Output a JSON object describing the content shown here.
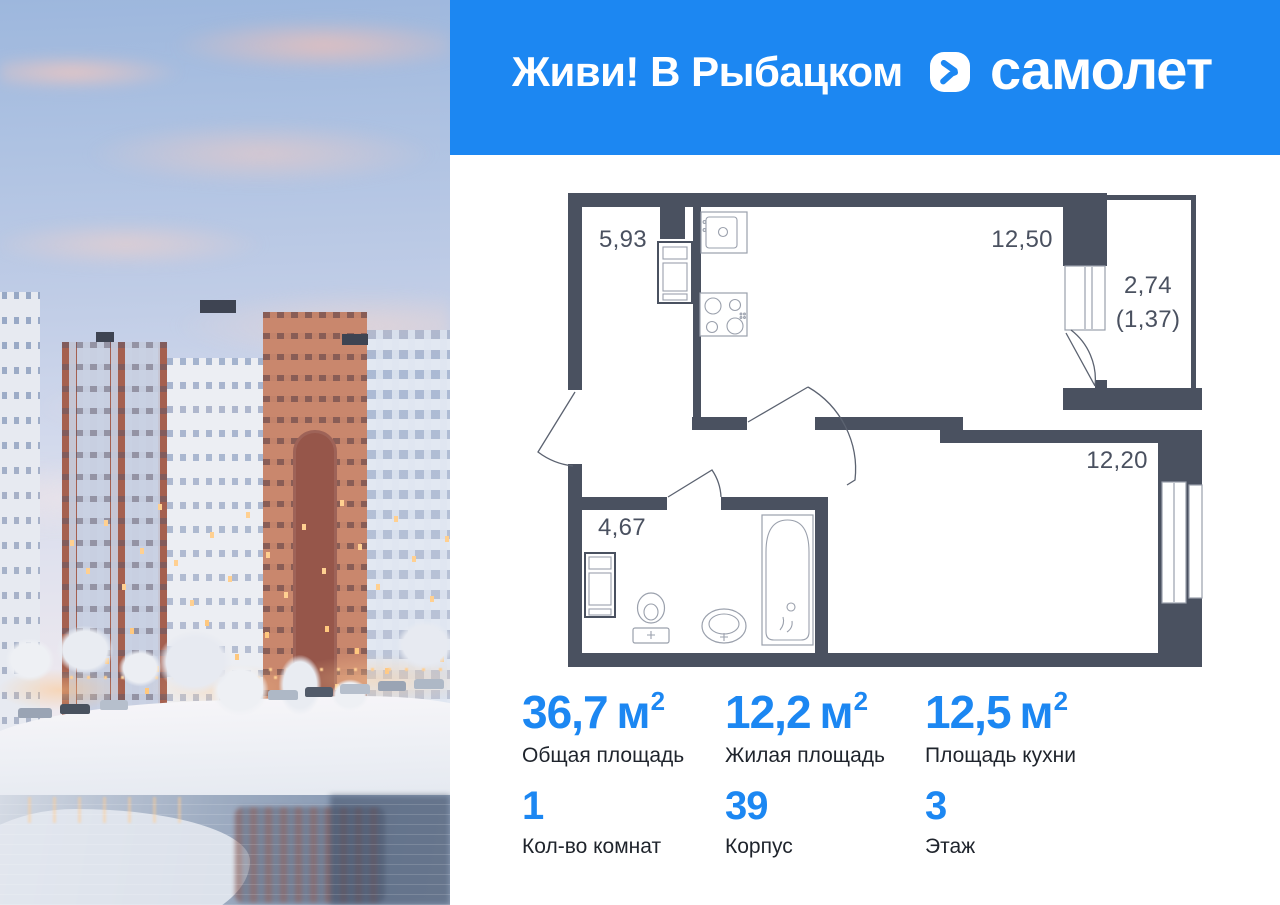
{
  "header": {
    "title": "Живи! В Рыбацком",
    "bg_color": "#1C87F2"
  },
  "brand": {
    "name": "самолет",
    "icon": "samolet-logo-icon"
  },
  "floorplan": {
    "wall_color": "#4A5160",
    "rooms": [
      {
        "name": "hallway",
        "area": "5,93"
      },
      {
        "name": "kitchen-living",
        "area": "12,50"
      },
      {
        "name": "balcony",
        "area": "2,74",
        "area_secondary": "(1,37)"
      },
      {
        "name": "bathroom",
        "area": "4,67"
      },
      {
        "name": "room",
        "area": "12,20"
      }
    ]
  },
  "stats": {
    "accent_color": "#1C87F2",
    "primary": [
      {
        "value": "36,7",
        "unit": "м",
        "unit_sup": "2",
        "label": "Общая площадь"
      },
      {
        "value": "12,2",
        "unit": "м",
        "unit_sup": "2",
        "label": "Жилая площадь"
      },
      {
        "value": "12,5",
        "unit": "м",
        "unit_sup": "2",
        "label": "Площадь кухни"
      }
    ],
    "secondary": [
      {
        "value": "1",
        "label": "Кол-во комнат"
      },
      {
        "value": "39",
        "label": "Корпус"
      },
      {
        "value": "3",
        "label": "Этаж"
      }
    ]
  }
}
